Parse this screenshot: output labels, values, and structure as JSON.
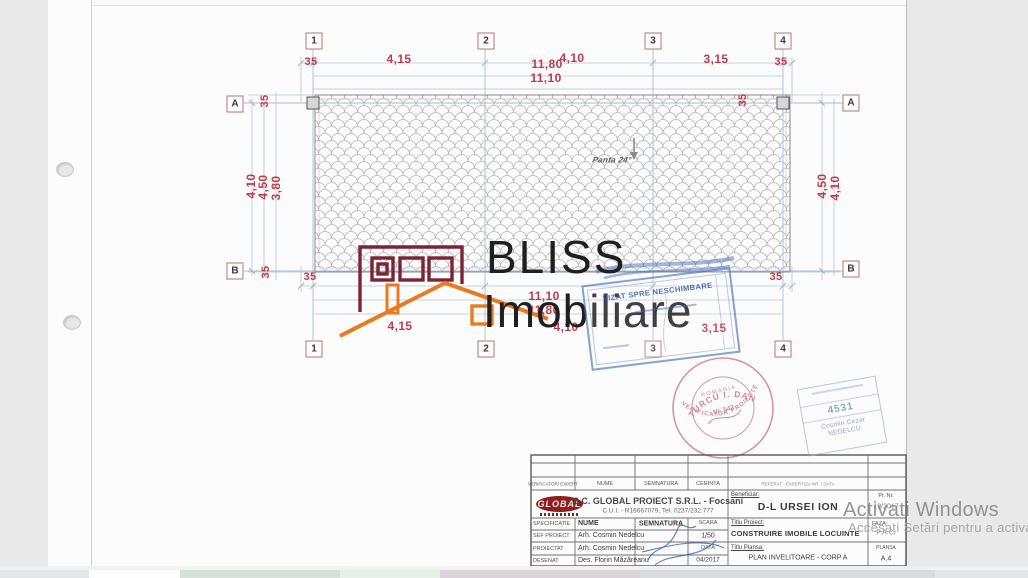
{
  "watermark": {
    "line1": "Activati Windows",
    "line2": "Accesați Setări pentru a activa Windows."
  },
  "brand": {
    "top": "BLISS",
    "bottom": "Imobiliare"
  },
  "plan": {
    "slope_label": "Panta 24°",
    "col_axes": [
      "1",
      "2",
      "3",
      "4"
    ],
    "row_axes": [
      "A",
      "B"
    ],
    "dims": {
      "d35": "35",
      "d415": "4,15",
      "d1180": "11,80",
      "d410": "4,10",
      "d1110": "11,10",
      "d315": "3,15",
      "d450": "4,50",
      "d380": "3,80"
    }
  },
  "stamps": {
    "vizat": {
      "title": "VIZAT SPRE NESCHIMBARE"
    },
    "round": {
      "arc_top": "TURCU I. DAN",
      "arc_bottom": "VERIFICATOR PROIECTE",
      "center1": "ROMANIA",
      "center2": "Nr. 547"
    },
    "oar": {
      "number": "4531",
      "name": "Cosmin Cezar",
      "surname": "NEDELCU"
    }
  },
  "titleblock": {
    "header": {
      "verificator": "VERIFICATOR/ EXPERT",
      "nume": "NUME",
      "semnatura": "SEMNATURA",
      "cerinta": "CERINTA"
    },
    "referat": "REFERAT - EXPERTIZA NR. / DATA",
    "company": {
      "logo": "GLOBAL",
      "name": "S.C. GLOBAL PROIECT S.R.L. - Focsani",
      "cui": "C.U.I. - R16667079, Tel. 0237/232.777"
    },
    "spec": {
      "specificatie": "SPECIFICATIE",
      "nume": "NUME",
      "semnatura": "SEMNATURA",
      "scara_label": "SCARA",
      "scara": "1/50",
      "data_label": "DATA",
      "data": "04/2017"
    },
    "rows": {
      "sef_label": "SEF PROIECT",
      "sef": "Arh. Cosmin Nedelcu",
      "proiectat_label": "PROIECTAT",
      "proiectat": "Arh. Cosmin Nedelcu",
      "desenat_label": "DESENAT",
      "desenat": "Des. Florin Măzăreanu"
    },
    "beneficiar_label": "Beneficiar:",
    "beneficiar": "D-L URSEI ION",
    "pr_label": "Pr. Nr.",
    "pr": "19/2017",
    "proiect_label": "Titlu Proiect:",
    "proiect": "CONSTRUIRE IMOBILE LOCUINTE",
    "faza_label": "FAZA:",
    "faza": "P.A.C.",
    "plansa_title_label": "Titlu Plansa:",
    "plansa_title": "PLAN INVELITOARE - CORP A",
    "plansa_label": "PLANSA",
    "plansa": "A.4"
  }
}
